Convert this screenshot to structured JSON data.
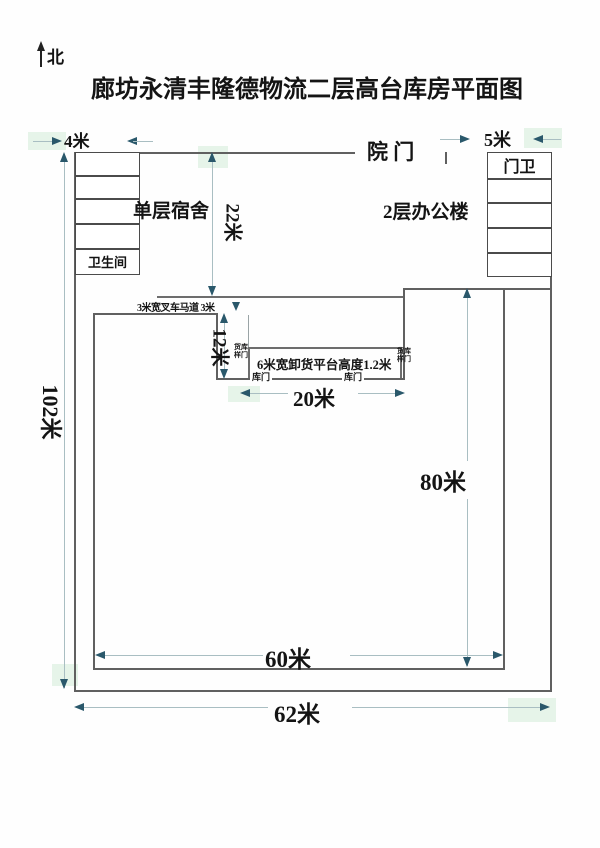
{
  "compass": {
    "label": "北"
  },
  "title": "廊坊永清丰隆德物流二层高台库房平面图",
  "site": {
    "gate_label": "院 门",
    "dorm": {
      "label": "单层宿舍",
      "toilet_label": "卫生间"
    },
    "office": {
      "label": "2层办公楼",
      "guard_label": "门卫"
    }
  },
  "platform": {
    "ramp_label": "3米宽叉车马道 3米",
    "label": "6米宽卸货平台高度1.2米",
    "dock_door_left": "库门",
    "dock_door_right": "库门",
    "side_door_left": {
      "line1": "货库",
      "line2": "样门"
    },
    "side_door_right": {
      "line1": "货库",
      "line2": "样门"
    }
  },
  "dimensions": {
    "dorm_width": "4米",
    "office_width": "5米",
    "yard_depth": "22米",
    "notch_depth": "12米",
    "platform_span": "20米",
    "site_height": "102米",
    "warehouse_height": "80米",
    "warehouse_width": "60米",
    "site_width": "62米"
  },
  "colors": {
    "wall": "#606060",
    "dim_line": "#a9bec2",
    "arrow": "#2a586b",
    "text": "#141414"
  }
}
